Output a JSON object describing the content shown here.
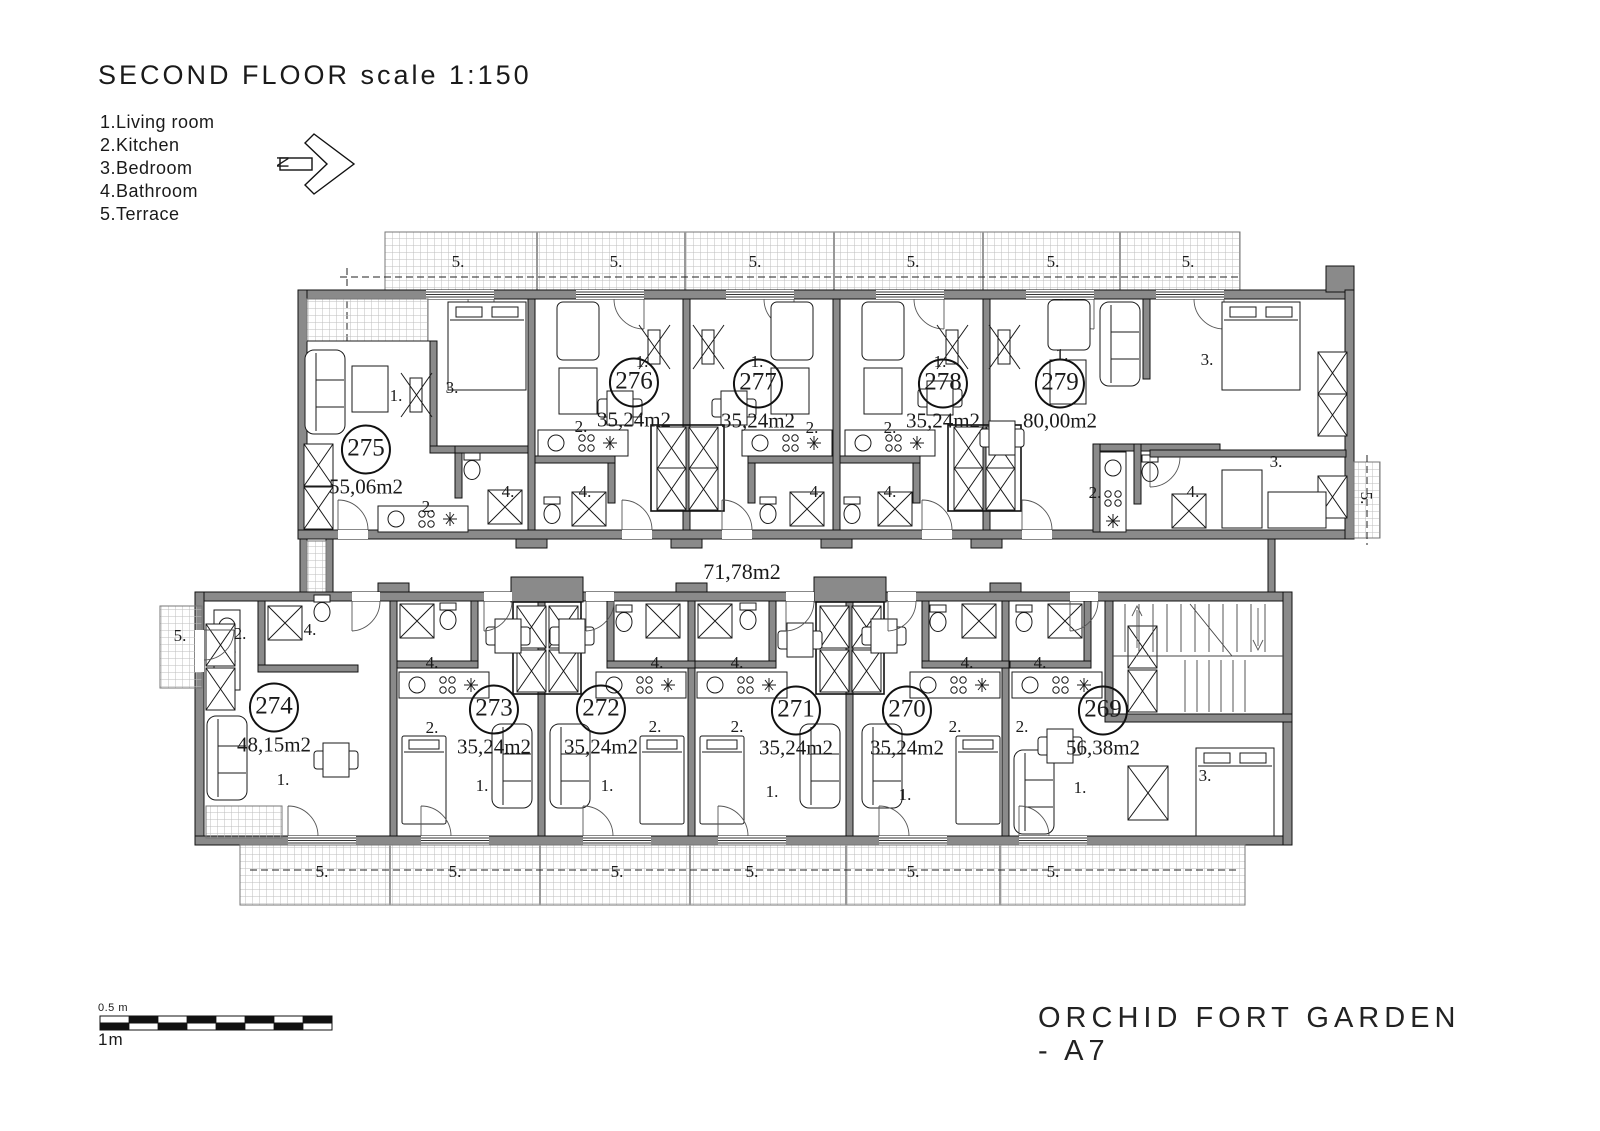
{
  "header": {
    "title": "SECOND FLOOR scale 1:150"
  },
  "legend": [
    "1.Living room",
    "2.Kitchen",
    "3.Bedroom",
    "4.Bathroom",
    "5.Terrace"
  ],
  "north": {
    "label": "N"
  },
  "corridor": {
    "area": "71,78m2"
  },
  "project": {
    "title": "ORCHID FORT GARDEN - A7"
  },
  "scale_bar": {
    "top_label": "0.5 m",
    "bottom_label": "1m"
  },
  "apartments": [
    {
      "no": "275",
      "area": "55,06m2",
      "x": 366,
      "y": 462
    },
    {
      "no": "276",
      "area": "35,24m2",
      "x": 634,
      "y": 395
    },
    {
      "no": "277",
      "area": "35,24m2",
      "x": 758,
      "y": 396
    },
    {
      "no": "278",
      "area": "35,24m2",
      "x": 943,
      "y": 396
    },
    {
      "no": "279",
      "area": "80,00m2",
      "x": 1060,
      "y": 396
    },
    {
      "no": "274",
      "area": "48,15m2",
      "x": 274,
      "y": 720
    },
    {
      "no": "273",
      "area": "35,24m2",
      "x": 494,
      "y": 722
    },
    {
      "no": "272",
      "area": "35,24m2",
      "x": 601,
      "y": 722
    },
    {
      "no": "271",
      "area": "35,24m2",
      "x": 796,
      "y": 723
    },
    {
      "no": "270",
      "area": "35,24m2",
      "x": 907,
      "y": 723
    },
    {
      "no": "269",
      "area": "56,38m2",
      "x": 1103,
      "y": 723
    }
  ],
  "annotations": [
    {
      "t": "5.",
      "x": 458,
      "y": 262
    },
    {
      "t": "5.",
      "x": 616,
      "y": 262
    },
    {
      "t": "5.",
      "x": 755,
      "y": 262
    },
    {
      "t": "5.",
      "x": 913,
      "y": 262
    },
    {
      "t": "5.",
      "x": 1053,
      "y": 262
    },
    {
      "t": "5.",
      "x": 1188,
      "y": 262
    },
    {
      "t": "1.",
      "x": 396,
      "y": 396
    },
    {
      "t": "3.",
      "x": 452,
      "y": 388
    },
    {
      "t": "2.",
      "x": 428,
      "y": 507
    },
    {
      "t": "4.",
      "x": 508,
      "y": 492
    },
    {
      "t": "2.",
      "x": 581,
      "y": 427
    },
    {
      "t": "1.",
      "x": 642,
      "y": 362
    },
    {
      "t": "4.",
      "x": 585,
      "y": 492
    },
    {
      "t": "1.",
      "x": 757,
      "y": 362
    },
    {
      "t": "2.",
      "x": 812,
      "y": 428
    },
    {
      "t": "4.",
      "x": 816,
      "y": 492
    },
    {
      "t": "2.",
      "x": 890,
      "y": 428
    },
    {
      "t": "1.",
      "x": 940,
      "y": 362
    },
    {
      "t": "4.",
      "x": 890,
      "y": 492
    },
    {
      "t": "1.",
      "x": 1062,
      "y": 355
    },
    {
      "t": "3.",
      "x": 1207,
      "y": 360
    },
    {
      "t": "2.",
      "x": 1095,
      "y": 493
    },
    {
      "t": "4.",
      "x": 1193,
      "y": 492
    },
    {
      "t": "3.",
      "x": 1276,
      "y": 462
    },
    {
      "t": "5.",
      "x": 1366,
      "y": 498,
      "r": 90
    },
    {
      "t": "5.",
      "x": 180,
      "y": 636
    },
    {
      "t": "2.",
      "x": 240,
      "y": 634
    },
    {
      "t": "4.",
      "x": 310,
      "y": 630
    },
    {
      "t": "1.",
      "x": 283,
      "y": 780
    },
    {
      "t": "4.",
      "x": 432,
      "y": 663
    },
    {
      "t": "2.",
      "x": 432,
      "y": 728
    },
    {
      "t": "1.",
      "x": 482,
      "y": 786
    },
    {
      "t": "4.",
      "x": 657,
      "y": 663
    },
    {
      "t": "2.",
      "x": 655,
      "y": 727
    },
    {
      "t": "1.",
      "x": 607,
      "y": 786
    },
    {
      "t": "4.",
      "x": 737,
      "y": 663
    },
    {
      "t": "2.",
      "x": 737,
      "y": 727
    },
    {
      "t": "1.",
      "x": 772,
      "y": 792
    },
    {
      "t": "4.",
      "x": 967,
      "y": 663
    },
    {
      "t": "2.",
      "x": 955,
      "y": 727
    },
    {
      "t": "1.",
      "x": 905,
      "y": 795
    },
    {
      "t": "4.",
      "x": 1040,
      "y": 663
    },
    {
      "t": "2.",
      "x": 1022,
      "y": 727
    },
    {
      "t": "1.",
      "x": 1080,
      "y": 788
    },
    {
      "t": "3.",
      "x": 1205,
      "y": 776
    },
    {
      "t": "5.",
      "x": 322,
      "y": 872
    },
    {
      "t": "5.",
      "x": 455,
      "y": 872
    },
    {
      "t": "5.",
      "x": 617,
      "y": 872
    },
    {
      "t": "5.",
      "x": 752,
      "y": 872
    },
    {
      "t": "5.",
      "x": 913,
      "y": 872
    },
    {
      "t": "5.",
      "x": 1053,
      "y": 872
    }
  ]
}
